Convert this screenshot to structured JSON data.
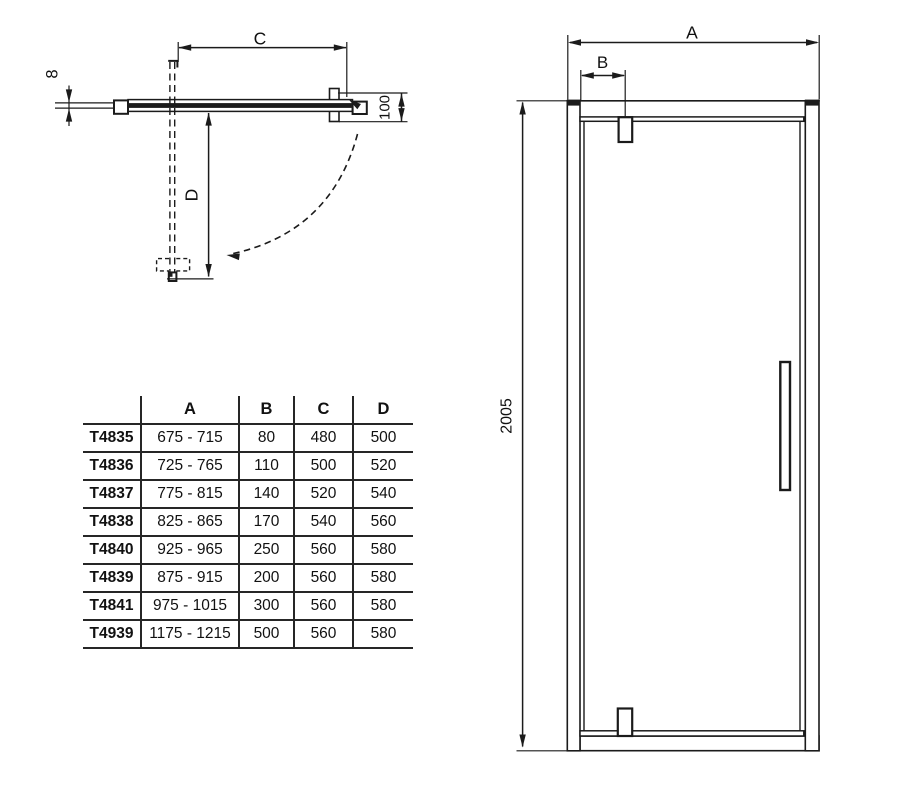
{
  "drawing": {
    "plan_view": {
      "width_label": "C",
      "swing_depth_label": "D",
      "glass_thickness_label": "8",
      "wall_offset_label": "100"
    },
    "front_view": {
      "width_label": "A",
      "hinge_offset_label": "B",
      "height_label": "2005"
    }
  },
  "size_table": {
    "headers": [
      "A",
      "B",
      "C",
      "D"
    ],
    "rows": [
      {
        "model": "T4835",
        "a": "675 - 715",
        "b": "80",
        "c": "480",
        "d": "500"
      },
      {
        "model": "T4836",
        "a": "725 - 765",
        "b": "110",
        "c": "500",
        "d": "520"
      },
      {
        "model": "T4837",
        "a": "775 - 815",
        "b": "140",
        "c": "520",
        "d": "540"
      },
      {
        "model": "T4838",
        "a": "825 - 865",
        "b": "170",
        "c": "540",
        "d": "560"
      },
      {
        "model": "T4840",
        "a": "925 - 965",
        "b": "250",
        "c": "560",
        "d": "580"
      },
      {
        "model": "T4839",
        "a": "875 - 915",
        "b": "200",
        "c": "560",
        "d": "580"
      },
      {
        "model": "T4841",
        "a": "975 - 1015",
        "b": "300",
        "c": "560",
        "d": "580"
      },
      {
        "model": "T4939",
        "a": "1175 - 1215",
        "b": "500",
        "c": "560",
        "d": "580"
      }
    ]
  },
  "colors": {
    "line": "#1b1b1b",
    "text": "#111111",
    "background": "#ffffff"
  }
}
